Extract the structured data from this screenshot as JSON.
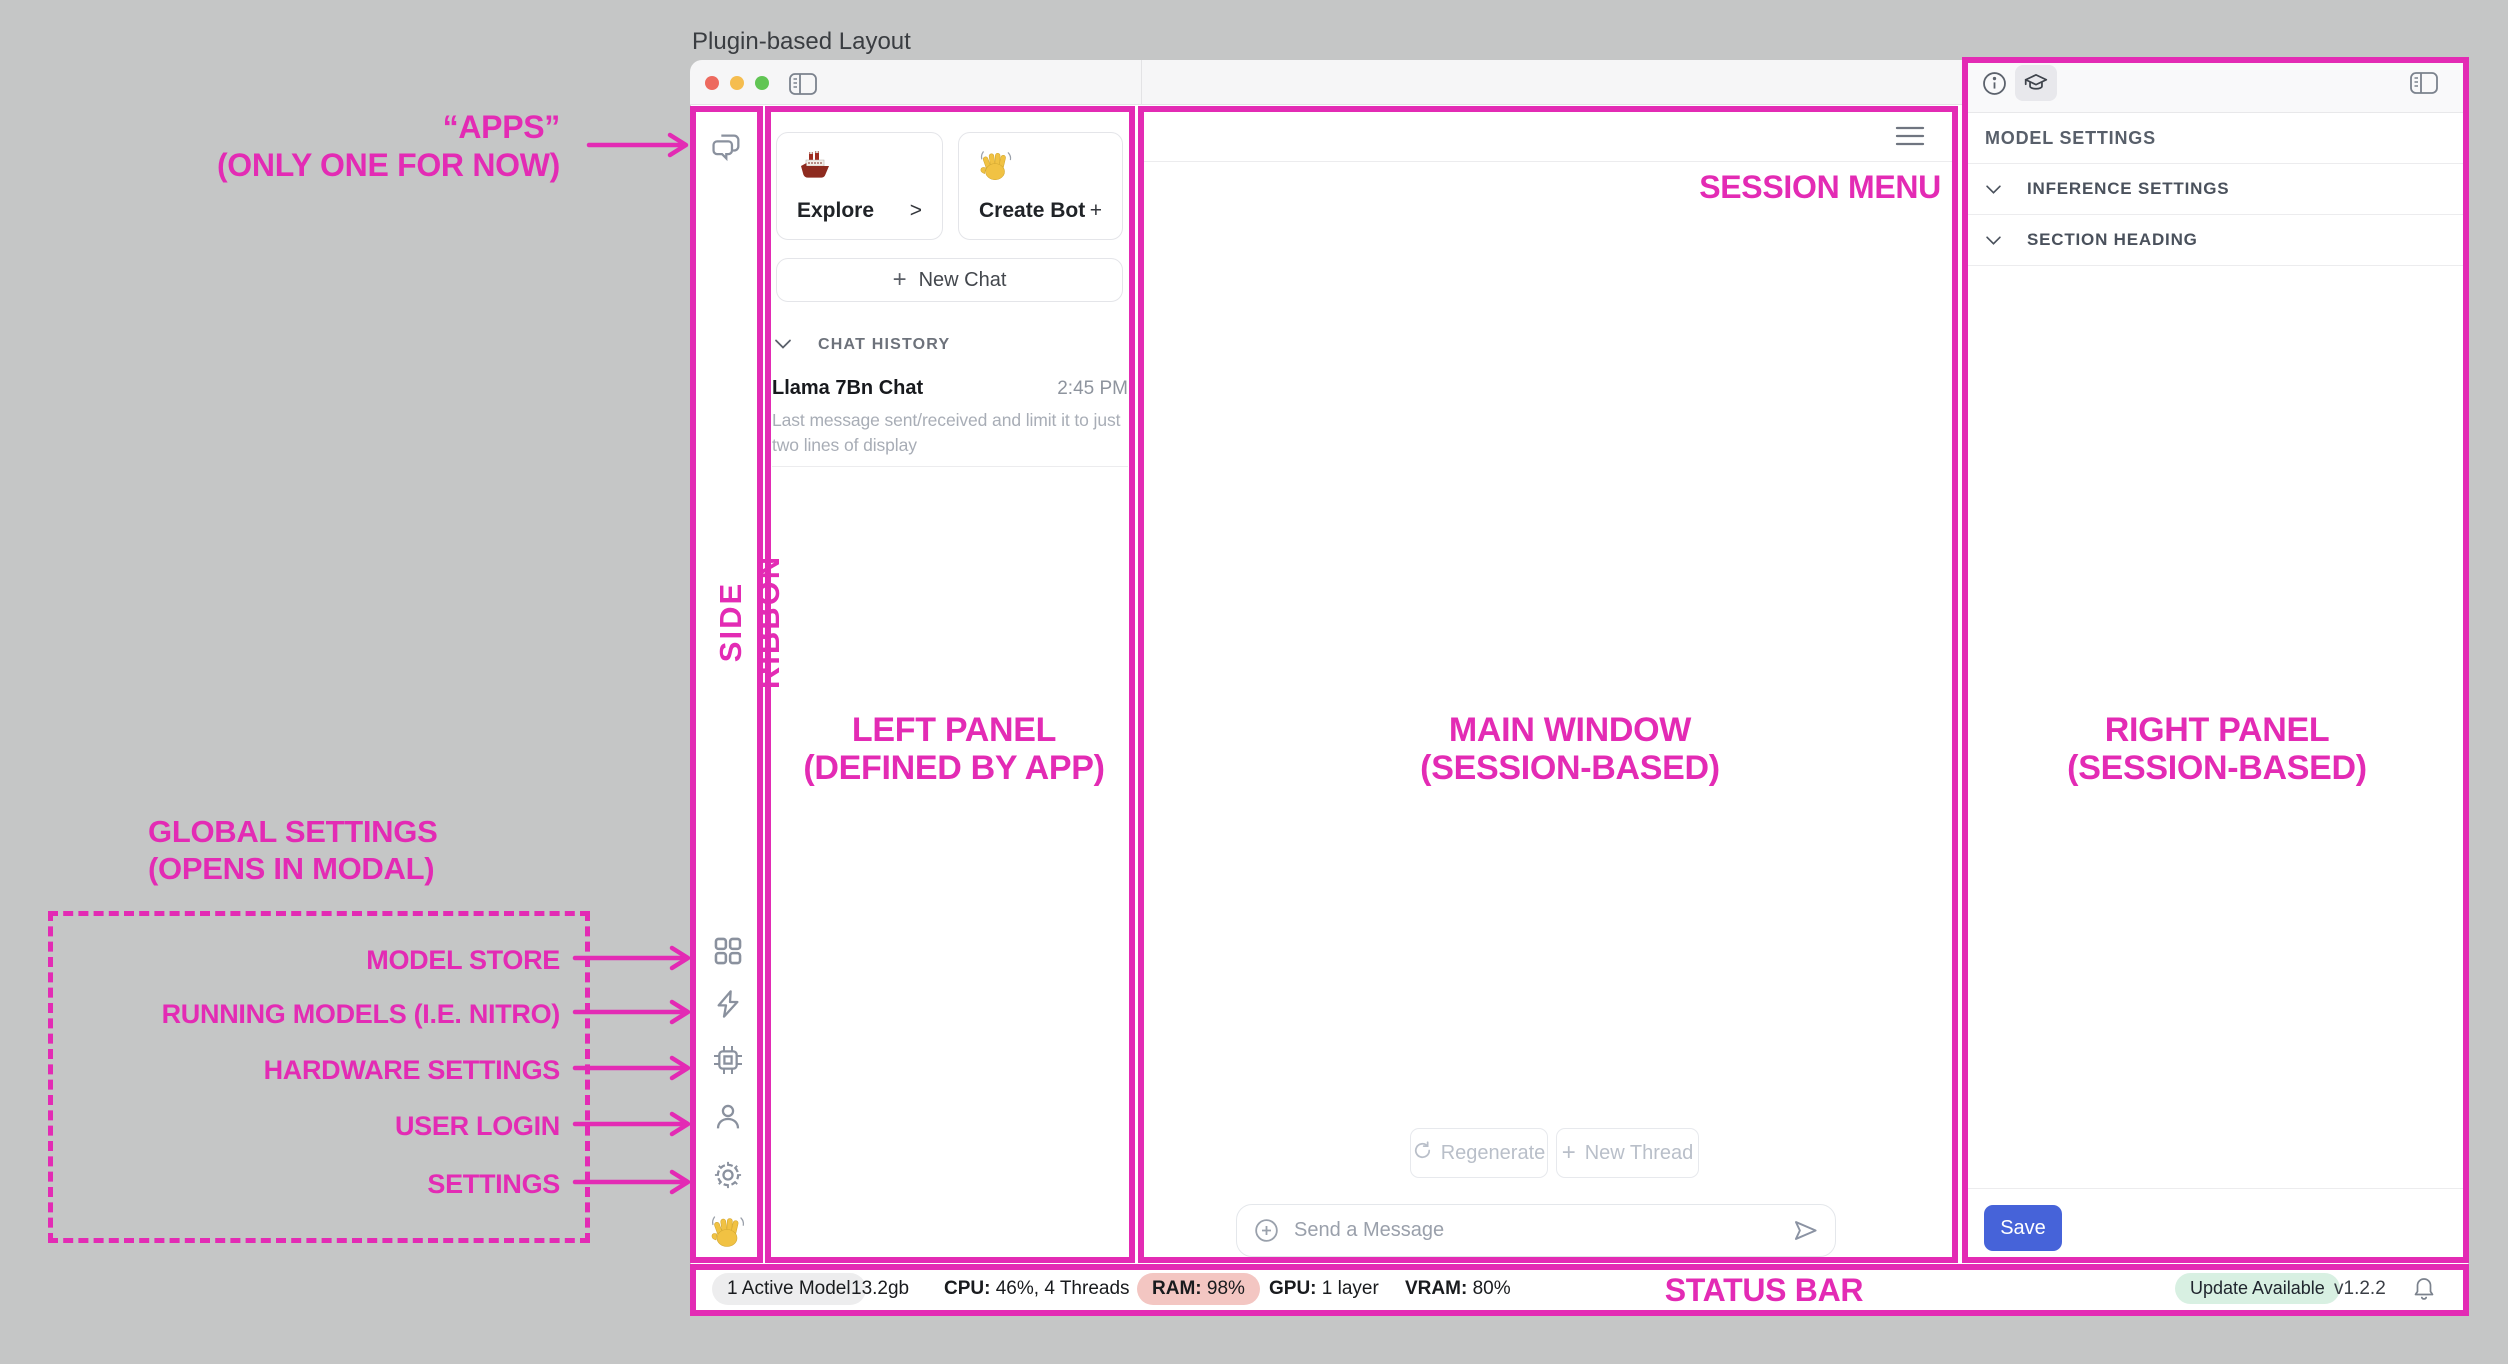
{
  "title": "Plugin-based Layout",
  "colors": {
    "accent": "#e32bb4",
    "save_blue": "#4663d9",
    "ram_pill_bg": "#f3c6c2",
    "update_pill_bg": "#d8f0e2",
    "model_pill_bg": "#ededee",
    "traffic_red": "#ed6a5f",
    "traffic_yellow": "#f5bd4f",
    "traffic_green": "#61c554"
  },
  "annotations": {
    "apps_line1": "“APPS”",
    "apps_line2": "(ONLY ONE FOR NOW)",
    "side_ribbon": "SIDE RIBBON",
    "left_panel_line1": "LEFT PANEL",
    "left_panel_line2": "(DEFINED BY APP)",
    "main_window_line1": "MAIN WINDOW",
    "main_window_line2": "(SESSION-BASED)",
    "right_panel_line1": "RIGHT PANEL",
    "right_panel_line2": "(SESSION-BASED)",
    "session_menu": "SESSION MENU",
    "status_bar": "STATUS BAR",
    "global_line1": "GLOBAL SETTINGS",
    "global_line2": "(OPENS IN MODAL)",
    "targets": [
      "MODEL STORE",
      "RUNNING MODELS (I.E. NITRO)",
      "HARDWARE SETTINGS",
      "USER LOGIN",
      "SETTINGS"
    ]
  },
  "left_panel": {
    "explore": {
      "label": "Explore",
      "affordance": ">"
    },
    "create_bot": {
      "label": "Create Bot",
      "affordance": "+"
    },
    "new_chat": {
      "plus": "+",
      "label": "New Chat"
    },
    "chat_history_header": "CHAT HISTORY",
    "chats": [
      {
        "title": "Llama 7Bn Chat",
        "time": "2:45 PM",
        "preview": "Last message sent/received and limit it to just two lines of display"
      }
    ]
  },
  "main": {
    "regenerate": "Regenerate",
    "new_thread_plus": "+",
    "new_thread": "New Thread",
    "composer_placeholder": "Send a Message"
  },
  "right_panel": {
    "header": "MODEL SETTINGS",
    "row1": "INFERENCE SETTINGS",
    "row2": "SECTION HEADING",
    "save": "Save"
  },
  "status_bar": {
    "active": "1 Active Model",
    "mem": "13.2gb",
    "cpu_label": "CPU:",
    "cpu": "46%, 4 Threads",
    "ram_label": "RAM:",
    "ram": "98%",
    "gpu_label": "GPU:",
    "gpu": "1 layer",
    "vram_label": "VRAM:",
    "vram": "80%",
    "update": "Update Available",
    "version": "v1.2.2"
  }
}
